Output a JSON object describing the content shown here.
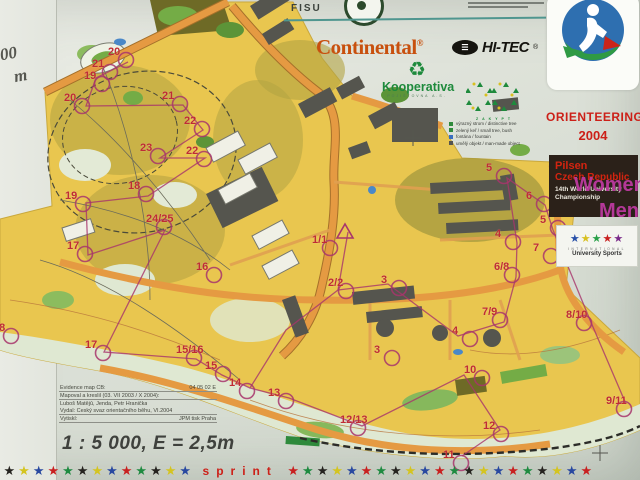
{
  "colors": {
    "poster_bg": "#dfe3da",
    "map_yellow": "#e9c64f",
    "road_orange": "#e59a42",
    "olive": "#b3a443",
    "building_gray": "#55554e",
    "green": "#74ac46",
    "control_red": "#bf2c35",
    "course_violet": "#a8356c",
    "category_magenta": "#b43898",
    "event_red": "#cc2018",
    "continental_orange": "#c8500e",
    "kooperativa_green": "#1e8a3c",
    "teal_line": "#4f968f"
  },
  "sponsors": {
    "fisu": "FISU",
    "continental": "Continental",
    "continental_mark": "®",
    "hitec_oval": "☰",
    "hitec": "HI-TEC",
    "hitec_mark": "®",
    "kooperativa_icon": "♻",
    "kooperativa": "Kooperativa",
    "kooperativa_sub": "POJIŠŤOVNA A.S.",
    "partner_letters": "ZAKYPT"
  },
  "event": {
    "title": "ORIENTEERING",
    "year": "2004",
    "city": "Pilsen",
    "country": "Czech Republic",
    "sub1": "14th World University",
    "sub2": "Championship",
    "fisu_int": "INTERNATIONAL",
    "fisu_us": "University Sports",
    "fisu_star_colors": [
      "#2850a8",
      "#d8c020",
      "#28a048",
      "#c82020",
      "#7a2a8a"
    ]
  },
  "categories": {
    "women": "Women",
    "men": "Men"
  },
  "map": {
    "edge_fragments": [
      {
        "text": "00",
        "x": 0,
        "y": 44
      },
      {
        "text": "m",
        "x": 14,
        "y": 66
      }
    ],
    "legend": [
      {
        "sym": "#2f8a3c",
        "text": "výrazný strom / distinctive tree"
      },
      {
        "sym": "#2f8a3c",
        "text": "zelený keř / small tree, bush"
      },
      {
        "sym": "#3a6fc0",
        "text": "fontána / fountain"
      },
      {
        "sym": "#555550",
        "text": "umělý objekt / man-made object"
      }
    ],
    "controls": [
      {
        "label": "20",
        "x": 108,
        "y": 46
      },
      {
        "label": "21",
        "x": 92,
        "y": 58
      },
      {
        "label": "19",
        "x": 84,
        "y": 70
      },
      {
        "label": "20",
        "x": 64,
        "y": 92
      },
      {
        "label": "21",
        "x": 162,
        "y": 90
      },
      {
        "label": "22",
        "x": 184,
        "y": 115
      },
      {
        "label": "23",
        "x": 140,
        "y": 142
      },
      {
        "label": "22",
        "x": 186,
        "y": 145
      },
      {
        "label": "18",
        "x": 128,
        "y": 180
      },
      {
        "label": "19",
        "x": 65,
        "y": 190
      },
      {
        "label": "24/25",
        "x": 146,
        "y": 213
      },
      {
        "label": "17",
        "x": 67,
        "y": 240
      },
      {
        "label": "16",
        "x": 196,
        "y": 261
      },
      {
        "label": "18",
        "x": -7,
        "y": 322
      },
      {
        "label": "17",
        "x": 85,
        "y": 339
      },
      {
        "label": "15/16",
        "x": 176,
        "y": 344
      },
      {
        "label": "15",
        "x": 205,
        "y": 360
      },
      {
        "label": "1/1",
        "x": 312,
        "y": 234
      },
      {
        "label": "2/2",
        "x": 328,
        "y": 277
      },
      {
        "label": "3",
        "x": 381,
        "y": 274
      },
      {
        "label": "3",
        "x": 374,
        "y": 344
      },
      {
        "label": "14",
        "x": 229,
        "y": 377
      },
      {
        "label": "13",
        "x": 268,
        "y": 387
      },
      {
        "label": "12/13",
        "x": 340,
        "y": 414
      },
      {
        "label": "10",
        "x": 464,
        "y": 364
      },
      {
        "label": "12",
        "x": 483,
        "y": 420
      },
      {
        "label": "11",
        "x": 443,
        "y": 449
      },
      {
        "label": "9/11",
        "x": 606,
        "y": 395
      },
      {
        "label": "8/10",
        "x": 566,
        "y": 309
      },
      {
        "label": "7/9",
        "x": 482,
        "y": 306
      },
      {
        "label": "6/8",
        "x": 494,
        "y": 261
      },
      {
        "label": "4",
        "x": 452,
        "y": 325
      },
      {
        "label": "4",
        "x": 495,
        "y": 228
      },
      {
        "label": "5",
        "x": 486,
        "y": 162
      },
      {
        "label": "5",
        "x": 540,
        "y": 214
      },
      {
        "label": "6",
        "x": 526,
        "y": 190
      },
      {
        "label": "7",
        "x": 533,
        "y": 242
      }
    ]
  },
  "infobox": {
    "rows": [
      {
        "label": "Evidence map ČB:",
        "value": "04 05 02 E",
        "line": true
      },
      {
        "label": "Mapoval a kreslil (03. VII 2003 / X 2004):",
        "value": "",
        "line": true
      },
      {
        "label": "Luboš Matějů, Jenda, Petr Hranička",
        "value": "",
        "line": false
      },
      {
        "label": "Vydal: Český svaz orientačního běhu, VI.2004",
        "value": "",
        "line": true
      },
      {
        "label": "Vytiskl:",
        "value": "JPM tisk Praha",
        "line": true
      }
    ],
    "scale": "1 : 5 000, E = 2,5m"
  },
  "footer": {
    "word": "sprint",
    "stars_before": 13,
    "stars_after": 21,
    "star_glyph": "★",
    "star_colors": [
      "#25231f",
      "#d4c420",
      "#2848a0",
      "#c82020",
      "#1e8a40"
    ]
  }
}
